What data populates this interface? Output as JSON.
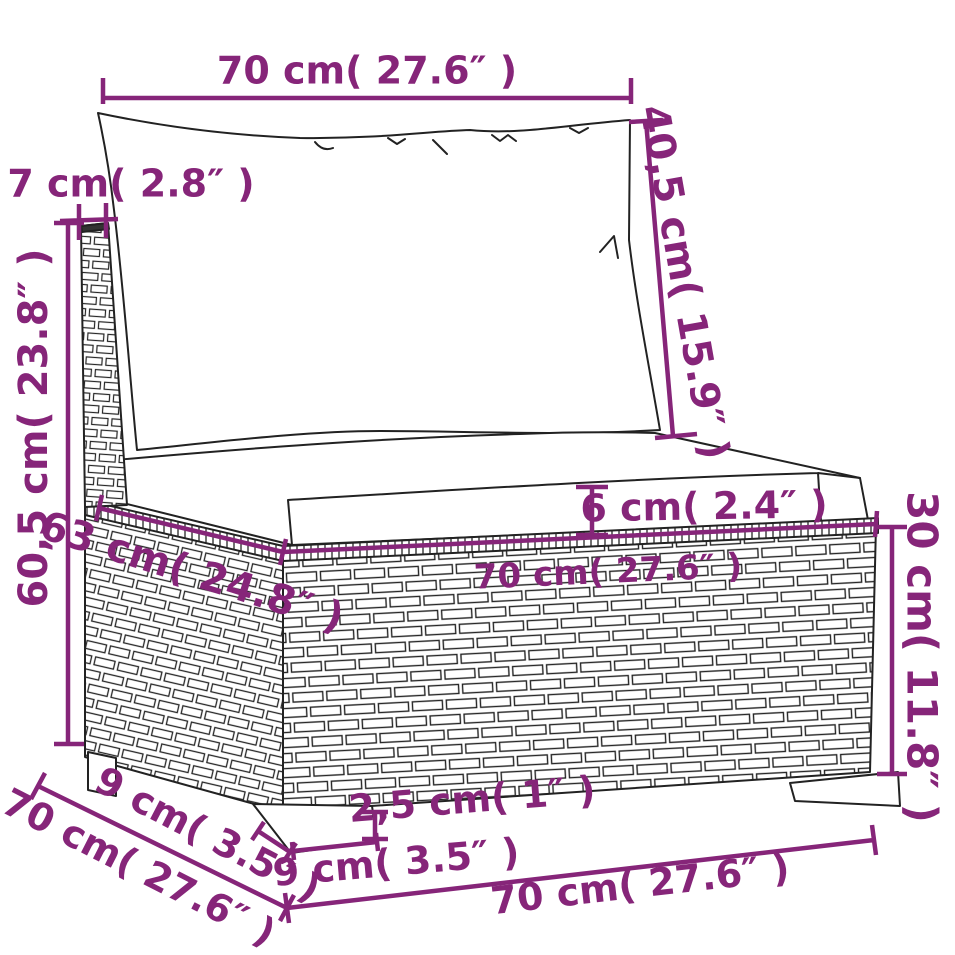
{
  "diagram": {
    "type": "product-dimension-diagram",
    "subject": "rattan-garden-sofa-middle-section-with-cushions",
    "background_color": "#ffffff",
    "outline_color": "#222222",
    "dimension_color": "#862579",
    "labels": {
      "top_width": "70 cm( 27.6″ )",
      "back_post_width": "7 cm( 2.8″ )",
      "total_height": "60,5 cm( 23.8″ )",
      "backrest_height": "40,5 cm( 15.9″ )",
      "cushion_thickness": "6 cm( 2.4″ )",
      "seat_top_depth": "63 cm( 24.8″ )",
      "seat_top_width": "70 cm( 27.6″ )",
      "base_height": "30 cm( 11.8″ )",
      "foot_height": "2,5 cm( 1″ )",
      "foot_depth": "9 cm( 3.5″ )",
      "foot_width": "9 cm( 3.5″ )",
      "base_bottom_depth": "70 cm( 27.6″ )",
      "base_bottom_width": "70 cm( 27.6″ )"
    }
  }
}
